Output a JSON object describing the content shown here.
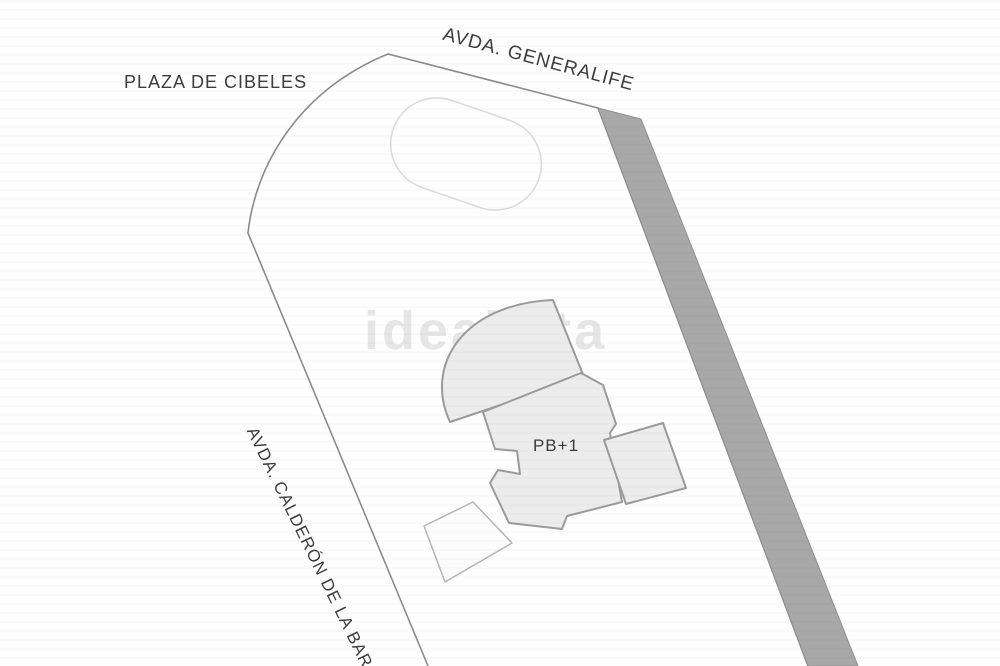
{
  "plan": {
    "type": "site-plan-sketch",
    "streets": {
      "generalife": {
        "label": "AVDA. GENERALIFE"
      },
      "cibeles": {
        "label": "PLAZA DE CIBELES"
      },
      "calderon": {
        "label": "AVDA. CALDERÓN DE LA BARCA"
      }
    },
    "building": {
      "label": "PB+1"
    },
    "watermark": {
      "text": "idealista"
    },
    "colors": {
      "background": "#fefefe",
      "plot_boundary_stroke": "#8c8c8c",
      "road_strip_fill": "#a8a8a8",
      "road_strip_stroke": "#8f8f8f",
      "building_fill": "#ececec",
      "building_stroke": "#9b9b9b",
      "pill_outline_stroke": "#dcdcdc",
      "white_square_stroke": "#b5b5b5",
      "watermark_color": "#e6e6e6",
      "label_color": "#3d3d3d"
    }
  }
}
